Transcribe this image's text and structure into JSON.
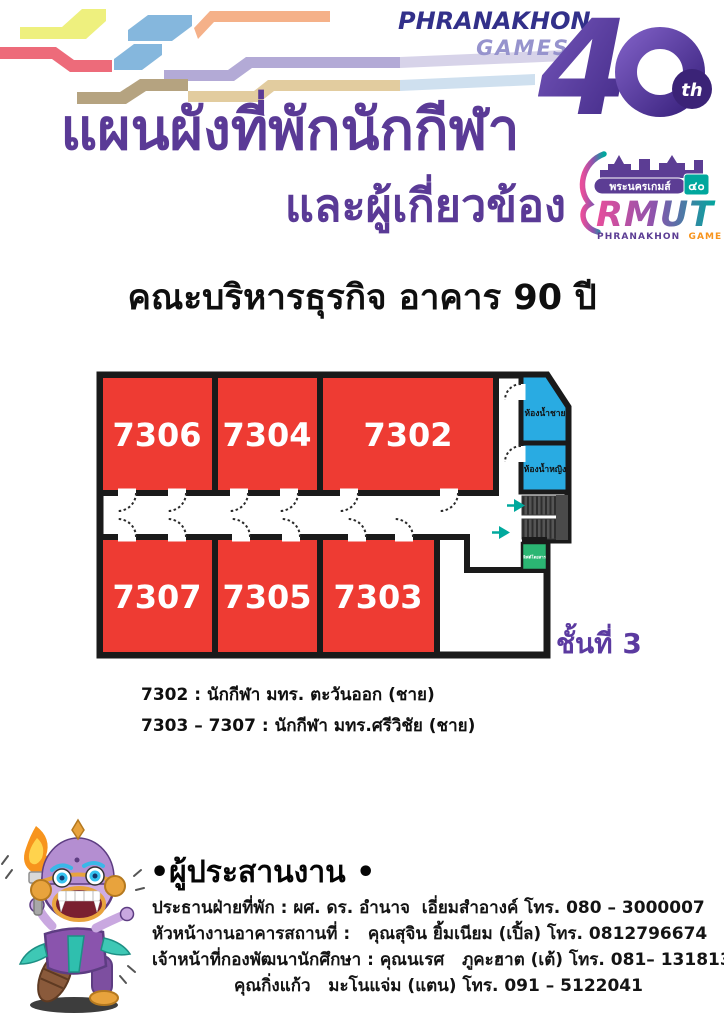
{
  "header": {
    "brand_top": "PHRANAKHON",
    "brand_bottom": "GAMES",
    "anniversary_digit": "4",
    "anniversary_suffix": "th"
  },
  "title": {
    "line1": "แผนผังที่พักนักกีฬา",
    "line2": "และผู้เกี่ยวข้อง"
  },
  "games_logo": {
    "thai_name": "พระนครเกมส์",
    "thai_number": "๔๐",
    "acronym": "RMUT",
    "english_name_1": "PHRANAKHON",
    "english_name_2": "GAMES"
  },
  "building_heading": "คณะบริหารธุรกิจ อาคาร 90 ปี",
  "floor_plan": {
    "floor_label": "ชั้นที่ 3",
    "rooms_top": [
      "7306",
      "7304",
      "7302"
    ],
    "rooms_bottom": [
      "7307",
      "7305",
      "7303"
    ],
    "male_restroom_label": "ห้องน้ำชาย",
    "female_restroom_label": "ห้องน้ำหญิง",
    "elevator_label": "ลิฟต์โดยสาร"
  },
  "legend": {
    "line1": "7302 : นักกีฬา มทร. ตะวันออก (ชาย)",
    "line2": "7303 – 7307 : นักกีฬา มทร.ศรีวิชัย (ชาย)"
  },
  "coordinators": {
    "heading": "•ผู้ประสานงาน •",
    "line1": "ประธานฝ่ายที่พัก : ผศ. ดร. อำนาจ  เอี่ยมสำอางค์ โทร. 080 – 3000007",
    "line2": "หัวหน้างานอาคารสถานที่ :   คุณสุจิน ยิ้มเนียม (เปิ้ล) โทร. 0812796674",
    "line3": "เจ้าหน้าที่กองพัฒนานักศึกษา : คุณนเรศ   ภูคะฮาต (เต้) โทร. 081– 1318131",
    "line4": "คุณกิ่งแก้ว   มะโนแจ่ม (แตน) โทร. 091 – 5122041"
  },
  "colors": {
    "title_purple": "#5a3a96",
    "floor_label_purple": "#5b3aa0",
    "room_red": "#ee3b33",
    "restroom_blue": "#29abe2",
    "elevator_green": "#2bb673",
    "stairs_gray": "#4a4a4a",
    "arrow_teal": "#00a99d",
    "wall_black": "#1a1a1a",
    "brand_dark_purple": "#32308a",
    "brand_light_purple": "#9693cd"
  }
}
